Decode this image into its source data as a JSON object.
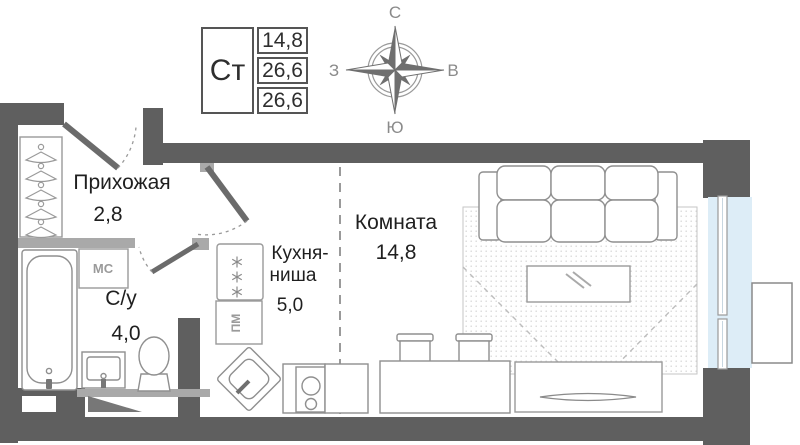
{
  "stamp": {
    "type": "Ст",
    "values": [
      "14,8",
      "26,6",
      "26,6"
    ]
  },
  "compass": {
    "n": "С",
    "e": "В",
    "s": "Ю",
    "w": "З"
  },
  "rooms": {
    "hallway": {
      "name": "Прихожая",
      "area": "2,8"
    },
    "bathroom": {
      "name": "С/у",
      "area": "4,0"
    },
    "kitchen": {
      "name_line1": "Кухня-",
      "name_line2": "ниша",
      "area": "5,0"
    },
    "living": {
      "name": "Комната",
      "area": "14,8"
    }
  },
  "labels": {
    "washing_machine": "МС",
    "dishwasher": "ПМ"
  },
  "icons": {
    "freezer_stars": "✳✳✳",
    "hangers_count": 5
  },
  "colors": {
    "wall": "#5f5f5f",
    "partition": "#a9a9a9",
    "furniture_stroke": "#8f8f8f",
    "window_glass": "#ddedf7",
    "text": "#1f1f1f",
    "muted_text": "#9a9a9a",
    "compass": "#6f6f6f"
  }
}
